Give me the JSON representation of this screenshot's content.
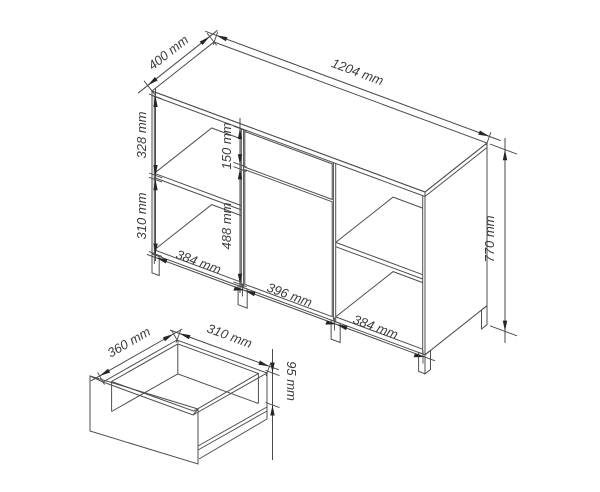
{
  "diagram": {
    "type": "furniture-dimension-drawing",
    "cabinet": {
      "width": "1204 mm",
      "depth": "400 mm",
      "height": "770 mm",
      "left_upper_compartment": "328 mm",
      "left_lower_compartment": "310 mm",
      "drawer_front_height": "150 mm",
      "door_height": "488 mm",
      "bottom_left_section": "384 mm",
      "bottom_middle_section": "396 mm",
      "bottom_right_section": "384 mm"
    },
    "drawer": {
      "depth": "360 mm",
      "width": "310 mm",
      "height": "95 mm"
    },
    "colors": {
      "line": "#4f4f4f",
      "arrow": "#262626",
      "text": "#3c3c3c",
      "background": "#ffffff"
    }
  }
}
